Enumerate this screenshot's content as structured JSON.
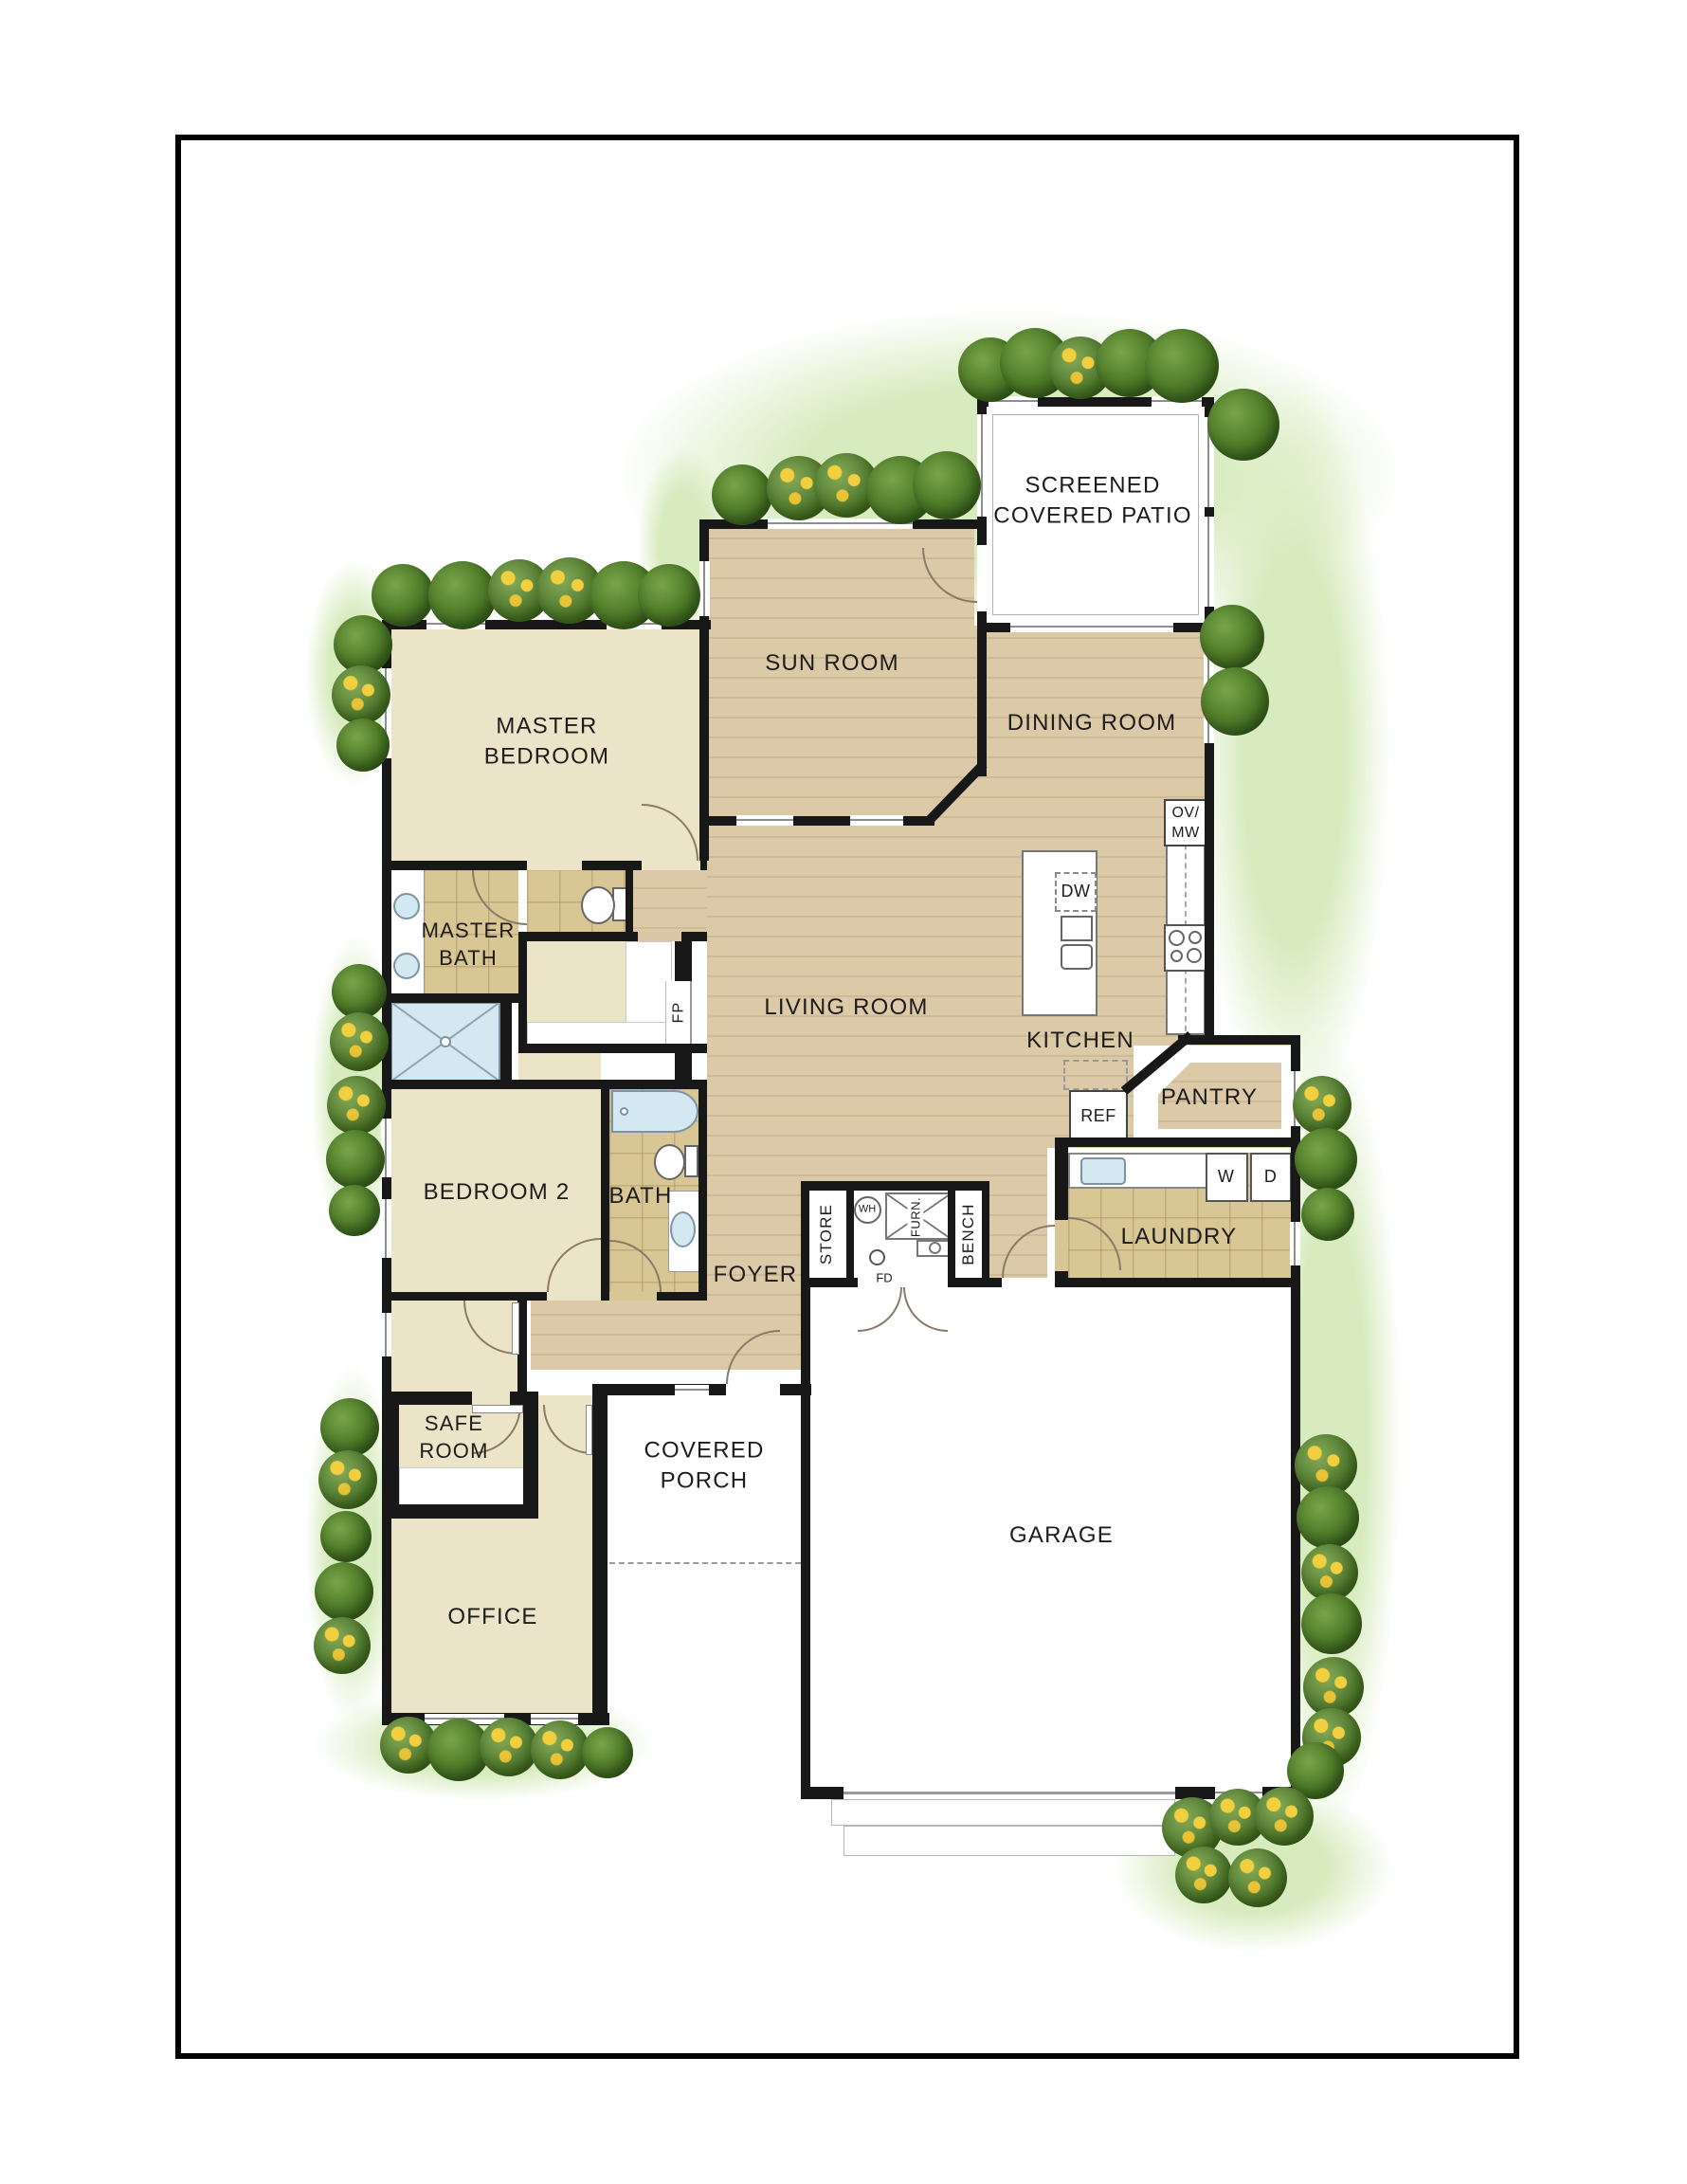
{
  "type": "residential-floor-plan",
  "colors": {
    "page_background": "#ffffff",
    "page_border": "#000000",
    "wall": "#181818",
    "wood_floor": "#d9c6a5",
    "cream_floor": "#ece4c8",
    "tile_floor": "#d9c695",
    "water_fixture": "#d4e8f2",
    "grass": "#d7ebbe",
    "shrub": "#4c7928",
    "flower": "#f2cf3e"
  },
  "labels": {
    "screened_patio": "SCREENED\nCOVERED PATIO",
    "sun_room": "SUN ROOM",
    "dining_room": "DINING ROOM",
    "master_bedroom": "MASTER\nBEDROOM",
    "master_bath": "MASTER\nBATH",
    "living_room": "LIVING ROOM",
    "kitchen": "KITCHEN",
    "pantry": "PANTRY",
    "bedroom_2": "BEDROOM 2",
    "bath": "BATH",
    "laundry": "LAUNDRY",
    "foyer": "FOYER",
    "store": "STORE",
    "water_heater": "WH",
    "furnace": "FURN.",
    "floor_drain": "FD",
    "bench": "BENCH",
    "safe_room": "SAFE\nROOM",
    "covered_porch": "COVERED\nPORCH",
    "office": "OFFICE",
    "garage": "GARAGE",
    "oven_microwave": "OV/\nMW",
    "dishwasher": "DW",
    "refrigerator": "REF",
    "washer": "W",
    "dryer": "D",
    "fireplace": "FP"
  },
  "rooms": [
    {
      "name": "SCREENED COVERED PATIO",
      "floor": "concrete"
    },
    {
      "name": "SUN ROOM",
      "floor": "wood"
    },
    {
      "name": "DINING ROOM",
      "floor": "wood"
    },
    {
      "name": "MASTER BEDROOM",
      "floor": "carpet"
    },
    {
      "name": "MASTER BATH",
      "floor": "tile"
    },
    {
      "name": "LIVING ROOM",
      "floor": "wood"
    },
    {
      "name": "KITCHEN",
      "floor": "wood"
    },
    {
      "name": "PANTRY",
      "floor": "wood"
    },
    {
      "name": "BEDROOM 2",
      "floor": "carpet"
    },
    {
      "name": "BATH",
      "floor": "tile"
    },
    {
      "name": "LAUNDRY",
      "floor": "tile"
    },
    {
      "name": "FOYER",
      "floor": "wood"
    },
    {
      "name": "SAFE ROOM",
      "floor": "carpet"
    },
    {
      "name": "COVERED PORCH",
      "floor": "concrete"
    },
    {
      "name": "OFFICE",
      "floor": "carpet"
    },
    {
      "name": "GARAGE",
      "floor": "concrete"
    }
  ]
}
